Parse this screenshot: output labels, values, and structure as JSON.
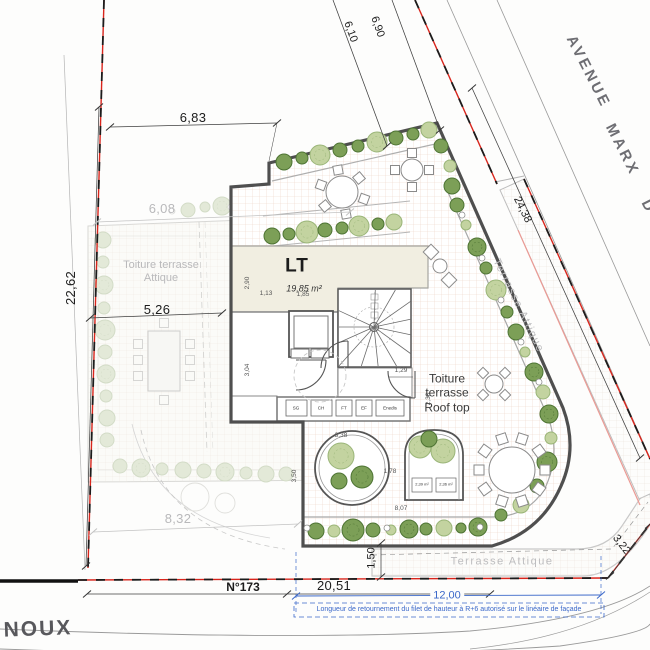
{
  "colors": {
    "boundary_red": "#d8251c",
    "note_blue": "#3b68c9",
    "bush_dark_fill": "#7c9f57",
    "bush_dark_stroke": "#4e7434",
    "bush_light_fill": "#c3d3a0",
    "bush_light_stroke": "#9ab578",
    "bush_faded_fill": "#dde5d0",
    "bush_faded_stroke": "#c9d4ba"
  },
  "streets": {
    "avenue_words": [
      "AVENUE",
      "MARX",
      "D"
    ],
    "street_bottom": "NOUX",
    "parcel_number": "N°173"
  },
  "rooms": {
    "lt_label": "LT",
    "lt_area": "19,85 m²",
    "rooftop_label": "Toiture terrasse Roof top",
    "attique_left_label": "Toiture terrasse Attique",
    "attique_right_label": "Terrasse Attique",
    "attique_bottom_label": "Terrasse Attique"
  },
  "utilities": [
    "SG",
    "CH",
    "FT",
    "EF",
    "Enedis"
  ],
  "planter_areas": [
    "2,39 m²",
    "2,36 m²"
  ],
  "dimensions": {
    "top_width": "6,83",
    "left_height": "22,62",
    "attique_top": "6,08",
    "lt_width": "5,26",
    "attique_bottom": "8,32",
    "diag_a": "6,10",
    "diag_b": "6,90",
    "avenue_frontage": "24,38",
    "bottom_frontage": "20,51",
    "facade_return": "12,00",
    "corner_cut": "3,22",
    "band_height": "1,50"
  },
  "minor_dimensions": {
    "m1": "2,90",
    "m2": "1,13",
    "m3": "1,85",
    "m4": "3,04",
    "m5": "1,29",
    "m6": "2,38",
    "m7": "3,38",
    "m8": "3,50",
    "m9": "1,78",
    "m10": "8,07"
  },
  "annotation": {
    "facade_note": "Longueur de retournement du filet de hauteur à R+6 autorisé sur le linéaire de façade"
  }
}
